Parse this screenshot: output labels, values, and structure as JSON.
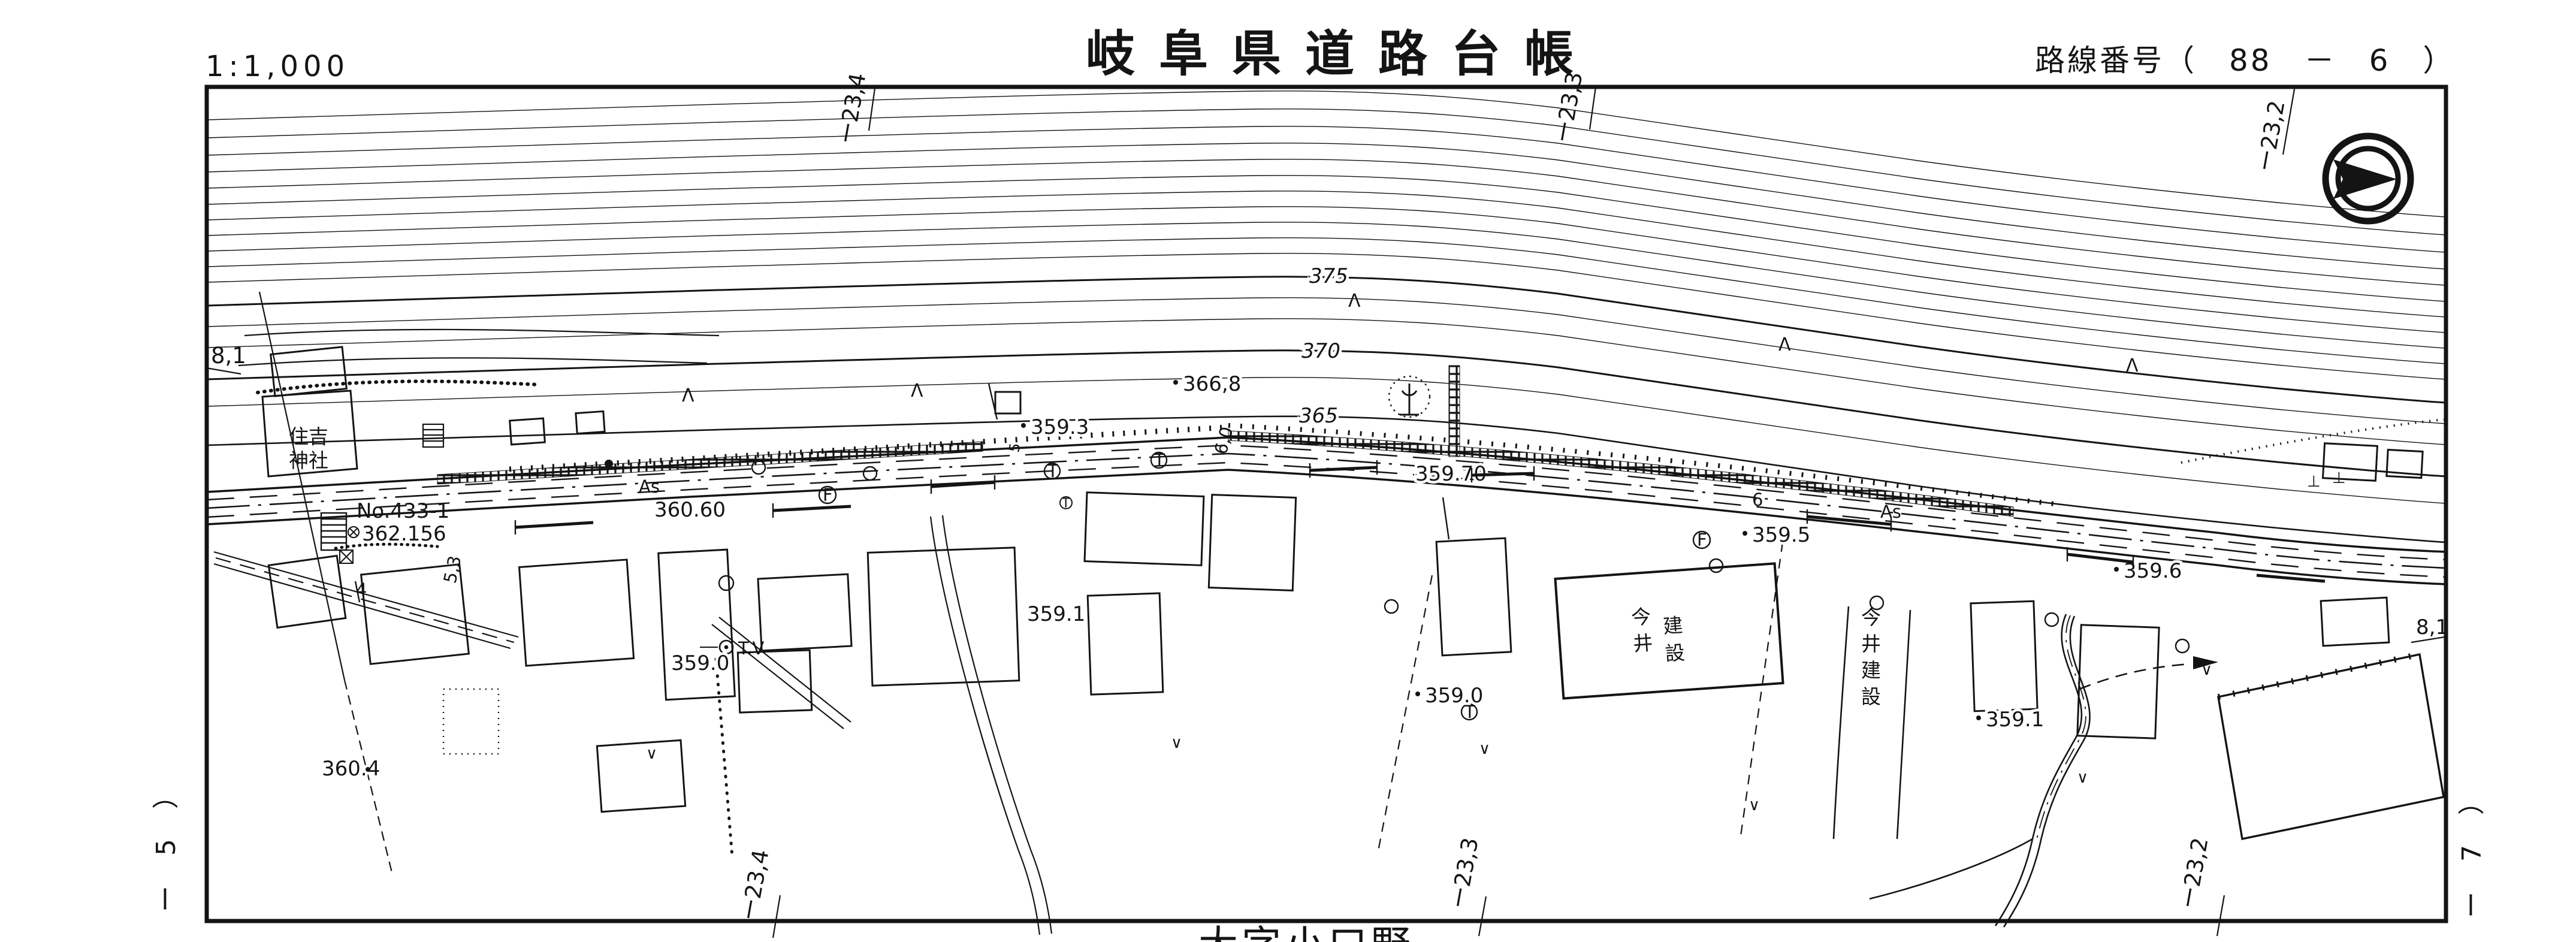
{
  "header": {
    "scale": "1:1,000",
    "title": "岐阜県道路台帳",
    "route_number": "路線番号（　88　－　6　）"
  },
  "margins": {
    "left_sheet": "ー 5 ）",
    "right_sheet": "ー 7 ）",
    "grid_x_1": "ー23,4",
    "grid_x_2": "ー23,3",
    "grid_x_3": "ー23,2",
    "grid_y": "8,1"
  },
  "labels": {
    "place_bottom": "大字小口野",
    "shrine_line1": "住吉",
    "shrine_line2": "神社",
    "point_no": "No.433-1",
    "benchmark_value": "362.156",
    "surface_as": "As",
    "elev_360_60": "360.60",
    "contour_375": "375",
    "contour_370": "370",
    "contour_365": "365",
    "spot_366_8": "366,8",
    "spot_359_3": "359.3",
    "spot_359_70": "359.70",
    "spot_359_5": "359.5",
    "spot_359_6": "359.6",
    "spot_359_1": "359.1",
    "spot_359_0": "359.0",
    "spot_360_4": "360.4",
    "tv_label": "T.V",
    "company": "今井建設",
    "width_4": "4",
    "width_5": "5",
    "width_5_3": "5,3",
    "width_6_0": "6,0",
    "width_6": "6",
    "pole_t": "T",
    "sym_f": "F",
    "tree_conifer": "Λ",
    "grass_v": "∨",
    "wall_t": "⊥"
  }
}
